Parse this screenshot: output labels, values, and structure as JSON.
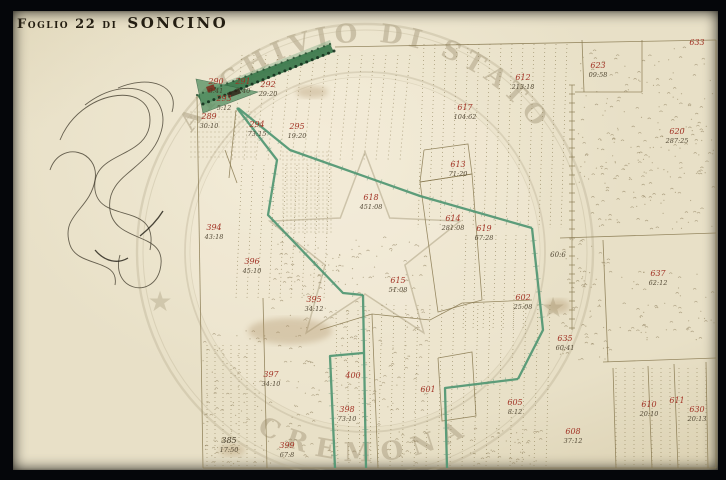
{
  "window": {
    "background": "#05060a"
  },
  "title": {
    "prefix": "Foglio 22 di",
    "name": "SONCINO"
  },
  "stamp": {
    "top_text": "ARCHIVIO DI STATO",
    "bottom_text": "CREMONA",
    "star_glyph": "★",
    "cx": 365,
    "cy": 252,
    "r_outer": 228,
    "r_outer2": 222,
    "r_inner": 180,
    "r_inner2": 175,
    "r_text": 210,
    "star_left": {
      "x": 160,
      "y": 301
    },
    "star_right": {
      "x": 553,
      "y": 307
    },
    "center_star_outer_r": 100,
    "center_star_inner_r": 42,
    "ring_color": "#b5aa8d",
    "text_color": "#a89c7e"
  },
  "map": {
    "paper_color": "#e8e0c7",
    "ink_color": "#87784f",
    "red_color": "#a23325",
    "note_color": "#433926",
    "green_color": "#4f9672",
    "dark_green_color": "#2c5c3c",
    "labels": [
      {
        "n": "290",
        "m": "3:41",
        "x": 216,
        "y": 84
      },
      {
        "n": "291",
        "m": "7:40",
        "x": 243,
        "y": 84
      },
      {
        "n": "292",
        "m": "29:20",
        "x": 268,
        "y": 87
      },
      {
        "n": "293",
        "m": "5:12",
        "x": 224,
        "y": 101
      },
      {
        "n": "289",
        "m": "30:10",
        "x": 209,
        "y": 119
      },
      {
        "n": "294",
        "m": "73:15",
        "x": 257,
        "y": 127
      },
      {
        "n": "295",
        "m": "19:20",
        "x": 297,
        "y": 129
      },
      {
        "n": "394",
        "m": "43:18",
        "x": 214,
        "y": 230
      },
      {
        "n": "396",
        "m": "45:10",
        "x": 252,
        "y": 264
      },
      {
        "n": "395",
        "m": "34:12",
        "x": 314,
        "y": 302
      },
      {
        "n": "397",
        "m": "34:10",
        "x": 271,
        "y": 377
      },
      {
        "n": "398",
        "m": "73:10",
        "x": 347,
        "y": 412
      },
      {
        "n": "399",
        "m": "67:8",
        "x": 287,
        "y": 448
      },
      {
        "n": "385",
        "m": "17:50",
        "x": 229,
        "y": 443,
        "black": true
      },
      {
        "n": "618",
        "m": "451:08",
        "x": 371,
        "y": 200
      },
      {
        "n": "613",
        "m": "71:20",
        "x": 458,
        "y": 167
      },
      {
        "n": "614",
        "m": "281:08",
        "x": 453,
        "y": 221
      },
      {
        "n": "619",
        "m": "67:28",
        "x": 484,
        "y": 231
      },
      {
        "n": "612",
        "m": "213:18",
        "x": 523,
        "y": 80
      },
      {
        "n": "617",
        "m": "104:62",
        "x": 465,
        "y": 110
      },
      {
        "n": "615",
        "m": "51:08",
        "x": 398,
        "y": 283
      },
      {
        "n": "623",
        "m": "09:58",
        "x": 598,
        "y": 68
      },
      {
        "n": "620",
        "m": "287:25",
        "x": 677,
        "y": 134
      },
      {
        "n": "633",
        "m": "",
        "x": 697,
        "y": 45
      },
      {
        "n": "637",
        "m": "62:12",
        "x": 658,
        "y": 276
      },
      {
        "n": "635",
        "m": "60:41",
        "x": 565,
        "y": 341
      },
      {
        "n": "602",
        "m": "25:08",
        "x": 523,
        "y": 300
      },
      {
        "n": "605",
        "m": "8:12",
        "x": 515,
        "y": 405
      },
      {
        "n": "608",
        "m": "37:12",
        "x": 573,
        "y": 434
      },
      {
        "n": "610",
        "m": "20:10",
        "x": 649,
        "y": 407
      },
      {
        "n": "611",
        "m": "",
        "x": 677,
        "y": 403
      },
      {
        "n": "630",
        "m": "20:13",
        "x": 697,
        "y": 412
      },
      {
        "n": "601",
        "m": "",
        "x": 428,
        "y": 392
      },
      {
        "n": "400",
        "m": "",
        "x": 353,
        "y": 378
      }
    ],
    "notes": [
      {
        "t": "60:6",
        "x": 558,
        "y": 257
      }
    ],
    "green_lines": [
      [
        [
          238,
          108
        ],
        [
          290,
          150
        ],
        [
          420,
          196
        ],
        [
          532,
          228
        ]
      ],
      [
        [
          532,
          228
        ],
        [
          543,
          330
        ],
        [
          518,
          379
        ]
      ],
      [
        [
          518,
          379
        ],
        [
          445,
          388
        ],
        [
          447,
          468
        ]
      ],
      [
        [
          237,
          108
        ],
        [
          277,
          160
        ],
        [
          268,
          215
        ],
        [
          343,
          293
        ],
        [
          363,
          295
        ]
      ],
      [
        [
          363,
          295
        ],
        [
          364,
          352
        ],
        [
          366,
          468
        ]
      ],
      [
        [
          363,
          353
        ],
        [
          330,
          356
        ],
        [
          335,
          468
        ]
      ]
    ],
    "green_band": [
      [
        197,
        95
      ],
      [
        330,
        44
      ],
      [
        334,
        52
      ],
      [
        203,
        105
      ]
    ],
    "green_band_halo": [
      [
        205,
        90
      ],
      [
        330,
        40
      ],
      [
        332,
        46
      ],
      [
        207,
        97
      ]
    ],
    "green_triangle": [
      [
        196,
        79
      ],
      [
        258,
        92
      ],
      [
        203,
        113
      ]
    ],
    "band_marks": [
      {
        "x": 206,
        "y": 87,
        "w": 8,
        "h": 6,
        "c": "#7e2a1c"
      },
      {
        "x": 227,
        "y": 93,
        "w": 13,
        "h": 5,
        "c": "#2f2518"
      }
    ],
    "boundaries": [
      [
        [
          197,
          95
        ],
        [
          203,
          468
        ]
      ],
      [
        [
          335,
          47
        ],
        [
          716,
          40
        ]
      ],
      [
        [
          716,
          40
        ],
        [
          716,
          468
        ]
      ],
      [
        [
          203,
          468
        ],
        [
          716,
          468
        ]
      ],
      [
        [
          575,
          92
        ],
        [
          642,
          92
        ]
      ],
      [
        [
          642,
          40
        ],
        [
          642,
          92
        ]
      ],
      [
        [
          582,
          40
        ],
        [
          584,
          92
        ]
      ],
      [
        [
          560,
          238
        ],
        [
          716,
          233
        ]
      ],
      [
        [
          603,
          240
        ],
        [
          608,
          362
        ]
      ],
      [
        [
          603,
          362
        ],
        [
          716,
          358
        ]
      ],
      [
        [
          613,
          368
        ],
        [
          616,
          468
        ]
      ],
      [
        [
          648,
          366
        ],
        [
          652,
          468
        ]
      ],
      [
        [
          674,
          364
        ],
        [
          678,
          468
        ]
      ],
      [
        [
          706,
          362
        ],
        [
          708,
          468
        ]
      ],
      [
        [
          424,
          150
        ],
        [
          468,
          144
        ],
        [
          472,
          174
        ],
        [
          420,
          182
        ],
        [
          424,
          150
        ]
      ],
      [
        [
          420,
          182
        ],
        [
          472,
          174
        ],
        [
          482,
          300
        ],
        [
          438,
          312
        ],
        [
          420,
          182
        ]
      ],
      [
        [
          438,
          358
        ],
        [
          472,
          352
        ],
        [
          476,
          416
        ],
        [
          442,
          421
        ],
        [
          438,
          358
        ]
      ],
      [
        [
          320,
          330
        ],
        [
          372,
          314
        ],
        [
          430,
          320
        ],
        [
          462,
          303
        ],
        [
          532,
          300
        ]
      ],
      [
        [
          372,
          314
        ],
        [
          378,
          468
        ]
      ],
      [
        [
          225,
          150
        ],
        [
          237,
          183
        ]
      ],
      [
        [
          236,
          110
        ],
        [
          229,
          178
        ]
      ],
      [
        [
          263,
          298
        ],
        [
          267,
          468
        ]
      ]
    ],
    "ladder": {
      "x": 572,
      "y0": 85,
      "y1": 330,
      "step": 9
    },
    "hatch_rows": [
      {
        "x0": 190,
        "x1": 258,
        "y0": 112,
        "y1": 160,
        "sp": 5
      },
      {
        "x0": 282,
        "x1": 332,
        "y0": 152,
        "y1": 235,
        "sp": 4
      }
    ],
    "dotted_regions": [
      {
        "x0": 242,
        "x1": 420,
        "y0": 55,
        "y1": 160,
        "sp": 12,
        "lean": -10
      },
      {
        "x0": 424,
        "x1": 572,
        "y0": 44,
        "y1": 228,
        "sp": 11,
        "lean": -6
      },
      {
        "x0": 242,
        "x1": 332,
        "y0": 165,
        "y1": 298,
        "sp": 11,
        "lean": -6
      },
      {
        "x0": 382,
        "x1": 560,
        "y0": 305,
        "y1": 466,
        "sp": 12,
        "lean": -4
      },
      {
        "x0": 466,
        "x1": 532,
        "y0": 235,
        "y1": 330,
        "sp": 10,
        "lean": -3
      },
      {
        "x0": 616,
        "x1": 706,
        "y0": 368,
        "y1": 466,
        "sp": 9,
        "lean": 0
      },
      {
        "x0": 207,
        "x1": 262,
        "y0": 345,
        "y1": 466,
        "sp": 8,
        "lean": 0
      },
      {
        "x0": 336,
        "x1": 372,
        "y0": 310,
        "y1": 466,
        "sp": 11,
        "lean": 2
      }
    ],
    "stipple_regions": [
      {
        "x0": 578,
        "y0": 48,
        "x1": 714,
        "y1": 230,
        "n": 240
      },
      {
        "x0": 560,
        "y0": 235,
        "x1": 610,
        "y1": 360,
        "n": 70
      },
      {
        "x0": 620,
        "y0": 268,
        "x1": 714,
        "y1": 340,
        "n": 60
      },
      {
        "x0": 268,
        "y0": 235,
        "x1": 425,
        "y1": 465,
        "n": 260
      },
      {
        "x0": 203,
        "y0": 330,
        "x1": 266,
        "y1": 465,
        "n": 80
      },
      {
        "x0": 468,
        "y0": 428,
        "x1": 540,
        "y1": 465,
        "n": 40
      }
    ],
    "smudges": [
      {
        "x": 290,
        "y": 331,
        "rx": 42,
        "ry": 13
      },
      {
        "x": 558,
        "y": 306,
        "rx": 12,
        "ry": 7
      },
      {
        "x": 232,
        "y": 450,
        "rx": 13,
        "ry": 6
      },
      {
        "x": 312,
        "y": 92,
        "rx": 16,
        "ry": 6
      }
    ],
    "flourishes": [
      "M60,140 C80,90 150,80 150,120 C150,160 90,150 95,190 C100,225 160,200 150,250",
      "M85,105 C130,70 175,95 160,135 C148,170 105,175 110,210 C115,245 170,230 160,270 C152,300 110,290 120,255",
      "M50,170 C60,140 100,150 95,180 C90,210 60,215 70,245 C78,268 120,258 115,285",
      "M118,88 C150,74 180,86 172,112",
      "M95,250 C105,262 118,264 128,258",
      "M140,236 C150,228 158,219 163,211"
    ]
  }
}
